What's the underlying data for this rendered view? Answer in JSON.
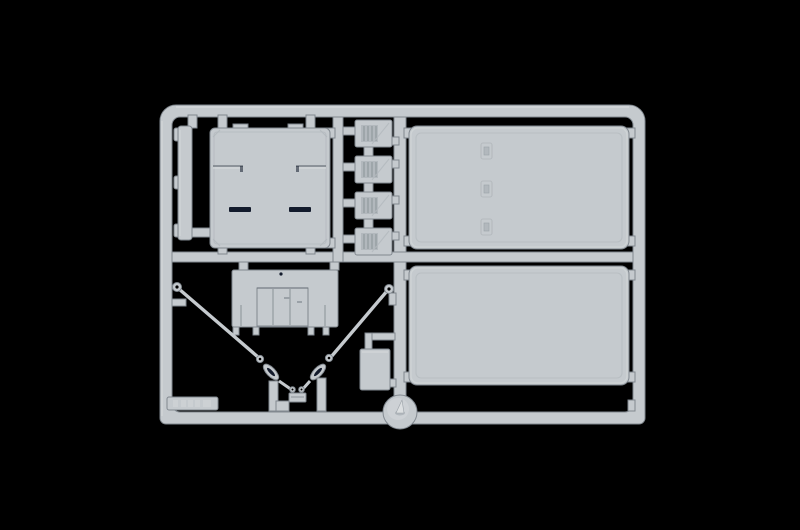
{
  "meta": {
    "type": "photograph",
    "subject": "light-grey injection-moulded model-kit sprue (parts tree) on a black background",
    "canvas": {
      "width": 800,
      "height": 530
    },
    "text_visible": "none (only a tiny illegible embossed code on a tab at lower left)"
  },
  "palette": {
    "background": "#000000",
    "plastic_face": "#c5cace",
    "plastic_light": "#dcdfe1",
    "plastic_mid": "#b2b8bd",
    "plastic_shadow": "#81888f",
    "plastic_dark": "#6b727a",
    "slot_dark": "#131b2c",
    "emboss": "#d3d7d9"
  },
  "parts": [
    {
      "id": "sprue-frame",
      "label": "rectangular runner frame with rounded top corners, centre vertical runner and centre horizontal runner"
    },
    {
      "id": "clip-strip-part",
      "label": "narrow vertical strip with three clip bumps, upper left"
    },
    {
      "id": "square-panel-part",
      "label": "large square cab panel with two dark slots and two step ledges, upper left"
    },
    {
      "id": "vent-block-parts",
      "label": "column of four small square blocks with vertical grille ribs and a diagonal score",
      "count": 4
    },
    {
      "id": "upper-side-panel-part",
      "label": "large rectangular panel with three small latch details, upper right"
    },
    {
      "id": "lower-side-panel-part",
      "label": "large plain rectangular panel with raised rim, lower right"
    },
    {
      "id": "hatch-panel-part",
      "label": "wide panel with raised double-door centre block and four bottom tabs, centre"
    },
    {
      "id": "tow-cable-part",
      "label": "V-shaped pair of thin tow cables with eyelets, oval chain links and a centre shackle"
    },
    {
      "id": "storage-box-part",
      "label": "small rectangular box part on L-shaped feed, centre right"
    },
    {
      "id": "dome-part",
      "label": "round dome with centre cone, seated on the bottom runner"
    },
    {
      "id": "marking-tab",
      "label": "small tab on bottom runner with embossed code (illegible)"
    }
  ]
}
